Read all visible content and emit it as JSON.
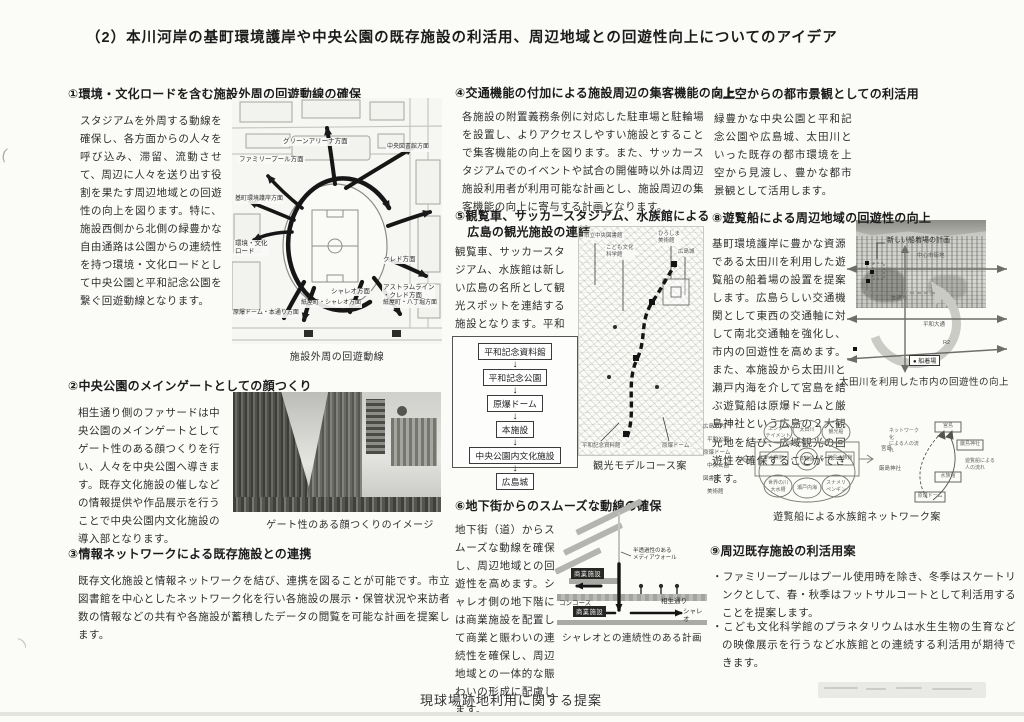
{
  "page": {
    "title": "（2）本川河岸の基町環境護岸や中央公園の既存施設の利活用、周辺地域との回遊性向上についてのアイデア",
    "footer": "現球場跡地利用に関する提案"
  },
  "s1": {
    "heading": "①環境・文化ロードを含む施設外周の回遊動線の確保",
    "body": "スタジアムを外周する動線を確保し、各方面からの人々を呼び込み、滞留、流動させて、周辺に人々を送り出す役割を果たす周辺地域との回遊性の向上を図ります。特に、施設西側から北側の緑豊かな自由通路は公園からの連続性を持つ環境・文化ロードとして中央公園と平和記念公園を繋ぐ回遊動線となります。",
    "map": {
      "caption": "施設外周の回遊動線",
      "labels": {
        "green_arena": "グリーンアリーナ方面",
        "library": "中央図書館方面",
        "family_pool": "ファミリープール方面",
        "motomachi": "基町環境護岸方面",
        "astram": "アストラムライン\n・クレド方面",
        "road": "環境・文化\nロード",
        "credo": "クレド方面",
        "chareo": "シャレオ方面",
        "kamiyacho_chareo": "紙屋町・シャレオ方面",
        "kamiyacho_hatchobori": "紙屋町・八丁堀方面",
        "dome_hondori": "原爆ドーム・本通り方面"
      }
    }
  },
  "s2": {
    "heading": "②中央公園のメインゲートとしての顔つくり",
    "body": "相生通り側のファサードは中央公園のメインゲートとしてゲート性のある顔つくりを行い、人々を中央公園へ導きます。既存文化施設の催しなどの情報提供や作品展示を行うことで中央公園内文化施設の導入部となります。",
    "caption": "ゲート性のある顔つくりのイメージ"
  },
  "s3": {
    "heading": "③情報ネットワークによる既存施設との連携",
    "body": "既存文化施設と情報ネットワークを結び、連携を図ることが可能です。市立図書館を中心としたネットワーク化を行い各施設の展示・保管状況や来訪者数の情報などの共有や各施設が蓄積したデータの閲覧を可能な計画を提案します。"
  },
  "s4": {
    "heading": "④交通機能の付加による施設周辺の集客機能の向上",
    "body": "各施設の附置義務条例に対応した駐車場と駐輪場を設置し、よりアクセスしやすい施設とすることで集客機能の向上を図ります。また、サッカースタジアムでのイベントや試合の開催時以外は周辺施設利用者が利用可能な計画とし、施設周辺の集客機能の向上に寄与する計画となります。"
  },
  "s5": {
    "heading": "⑤観覧車、サッカースタジアム、水族館による\n　広島の観光施設の連結",
    "body": "観覧車、サッカースタジアム、水族館は新しい広島の名所として観光スポットを連結する施設となります。平和記念公園から広島城までの観光モデルコースを構築します。",
    "flow": [
      "平和記念資料館",
      "平和記念公園",
      "原爆ドーム",
      "本施設",
      "中央公園内文化施設",
      "広島城"
    ],
    "map": {
      "caption": "観光モデルコース案",
      "labels": {
        "library": "市立中央図書館",
        "science": "こども文化\n科学館",
        "museum": "ひろしま\n美術館",
        "castle": "広島城",
        "memorial": "平和記念資料館",
        "dome": "原爆ドーム"
      }
    }
  },
  "s6": {
    "heading": "⑥地下街からのスムーズな動線の確保",
    "body": "地下街（道）からスムーズな動線を確保し、周辺地域との回遊性を高めます。シャレオ側の地下階には商業施設を配置して商業と賑わいの連続性を確保し、周辺地域との一体的な賑わいの形成に配慮します。",
    "diagram": {
      "caption": "シャレオとの連続性のある計画",
      "media_wall": "半透過性のある\nメディアウォール",
      "commercial_upper": "商業施設",
      "concourse": "コンコース",
      "aioi": "相生通り",
      "commercial_lower": "商業施設",
      "chareo": "シャレオ"
    }
  },
  "s7": {
    "heading": "⑦上空からの都市景観としての利活用",
    "body": "緑豊かな中央公園と平和記念公園や広島城、太田川といった既存の都市環境を上空から見渡し、豊かな都市景観として活用します。"
  },
  "s8": {
    "heading": "⑧遊覧船による周辺地域の回遊性の向上",
    "body": "基町環境護岸に豊かな資源である太田川を利用した遊覧船の船着場の設置を提案します。広島らしい交通機関として東西の交通軸に対して南北交通軸を強化し、市内の回遊性を高めます。また、本施設から太田川と瀬戸内海を介して宮島を結ぶ遊覧船は原爆ドームと厳島神社という広島の２大観光地を結び、広域観光の回遊性を確保することができます。",
    "river": {
      "new_pier": "新しい船着場の計画",
      "center_city": "中心市街地",
      "hondori": "本通り",
      "peace_blvd": "平和大通",
      "r2": "R2",
      "legend": "●  船着場",
      "caption": "太田川を利用した市内の回遊性の向上"
    },
    "network": {
      "caption": "遊覧船による水族館ネットワーク案",
      "left_nodes": [
        "広島市内",
        "平和公園",
        "原爆ドーム",
        "中央公園",
        "図書館",
        "美術館"
      ],
      "right_nodes": [
        "宮島",
        "厳島神社"
      ],
      "box_left": "新水族館",
      "box_center": "本施設",
      "box_right": "宮島水族館",
      "ell_top_left": "エンター\nテイメント",
      "ell_top_center": "太田川",
      "ell_top_right": "観光船",
      "ell_bottom_left": "世界の川\n大水槽",
      "ell_bottom_center": "瀬戸内海",
      "ell_bottom_right": "スナメリ\nペンギン",
      "flow_top": "宮島",
      "flow_right": "厳島神社",
      "flow_mid": "水族館",
      "flow_bottom": "原爆ドーム",
      "flow_label_left": "ネットワーク化\nによる人の流れ",
      "flow_label_right": "遊覧船による\n人の流れ"
    }
  },
  "s9": {
    "heading": "⑨周辺既存施設の利活用案",
    "bullets": [
      "・ファミリープールはプール使用時を除き、冬季はスケートリンクとして、春・秋季はフットサルコートとして利活用することを提案します。",
      "・こども文化科学館のプラネタリウムは水生生物の生育などの映像展示を行うなど水族館との連続する利活用が期待できます。"
    ]
  }
}
